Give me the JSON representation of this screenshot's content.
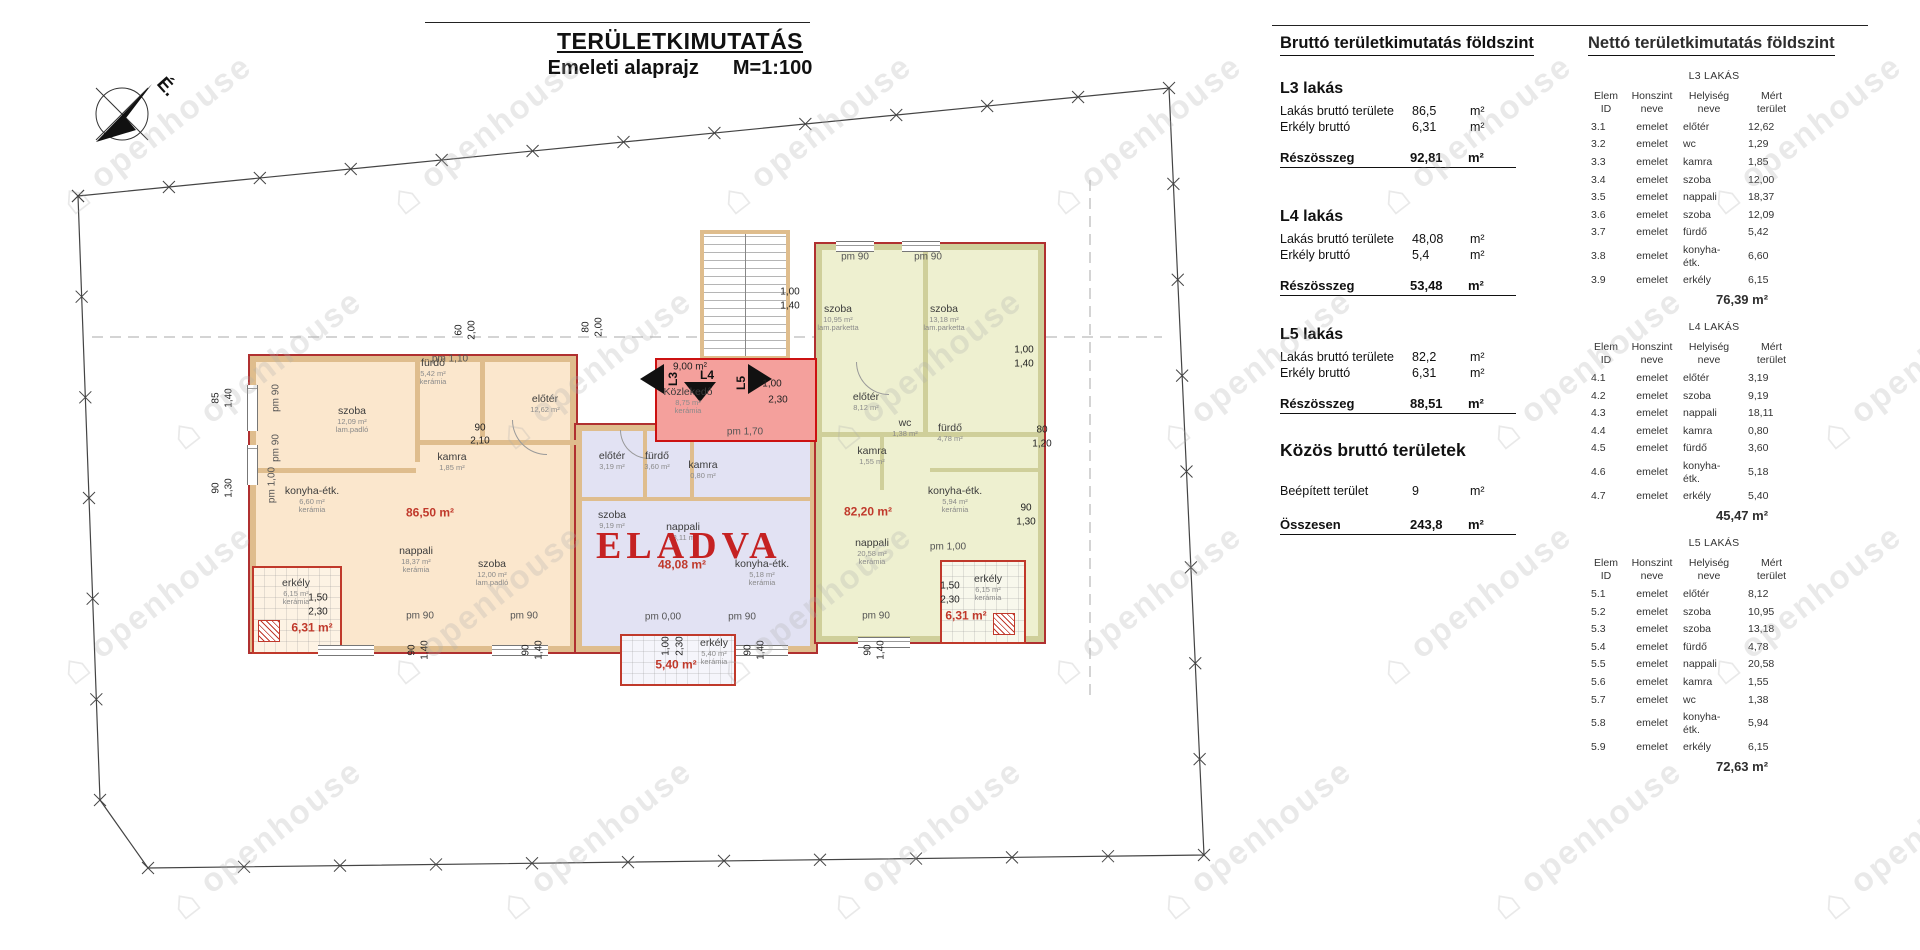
{
  "title": {
    "main": "TERÜLETKIMUTATÁS",
    "sub": "Emeleti alaprajz",
    "scale": "M=1:100"
  },
  "watermark": "openhouse",
  "plan": {
    "north_label": "É.",
    "units": [
      {
        "id": "L3",
        "fill": "#fbe7cd",
        "area": "86,50 m²"
      },
      {
        "id": "L4",
        "fill": "#e2e2f3",
        "area": "48,08 m²",
        "status": "ELADVA"
      },
      {
        "id": "L5",
        "fill": "#eef0d0",
        "area": "82,20 m²"
      }
    ],
    "corridor": {
      "doors": [
        "L3",
        "L4",
        "L5"
      ]
    },
    "labels": [
      {
        "k": "room",
        "t": "fürdő",
        "s": "5,42 m²",
        "s2": "kerámia",
        "x": 433,
        "y": 372
      },
      {
        "k": "room",
        "t": "szoba",
        "s": "12,09 m²",
        "s2": "lam.padló",
        "x": 352,
        "y": 420
      },
      {
        "k": "room",
        "t": "kamra",
        "s": "1,85 m²",
        "x": 452,
        "y": 462
      },
      {
        "k": "room",
        "t": "konyha-étk.",
        "s": "6,60 m²",
        "s2": "kerámia",
        "x": 312,
        "y": 500
      },
      {
        "k": "room",
        "t": "nappali",
        "s": "18,37 m²",
        "s2": "kerámia",
        "x": 416,
        "y": 560
      },
      {
        "k": "room",
        "t": "szoba",
        "s": "12,00 m²",
        "s2": "lam.padló",
        "x": 492,
        "y": 573
      },
      {
        "k": "room",
        "t": "előtér",
        "s": "12,62 m²",
        "x": 545,
        "y": 404
      },
      {
        "k": "red",
        "t": "86,50 m²",
        "x": 430,
        "y": 513
      },
      {
        "k": "room",
        "t": "előtér",
        "s": "3,19 m²",
        "x": 612,
        "y": 461
      },
      {
        "k": "room",
        "t": "fürdő",
        "s": "3,60 m²",
        "x": 657,
        "y": 461
      },
      {
        "k": "room",
        "t": "kamra",
        "s": "0,80 m²",
        "x": 703,
        "y": 470
      },
      {
        "k": "room",
        "t": "szoba",
        "s": "9,19 m²",
        "x": 612,
        "y": 520
      },
      {
        "k": "room",
        "t": "nappali",
        "s": "18,11 m²",
        "x": 683,
        "y": 532
      },
      {
        "k": "room",
        "t": "konyha-étk.",
        "s": "5,18 m²",
        "s2": "kerámia",
        "x": 762,
        "y": 573
      },
      {
        "k": "red",
        "t": "48,08 m²",
        "x": 682,
        "y": 565
      },
      {
        "k": "room",
        "t": "szoba",
        "s": "10,95 m²",
        "s2": "lam.parketta",
        "x": 838,
        "y": 318
      },
      {
        "k": "room",
        "t": "szoba",
        "s": "13,18 m²",
        "s2": "lam.parketta",
        "x": 944,
        "y": 318
      },
      {
        "k": "room",
        "t": "előtér",
        "s": "8,12 m²",
        "x": 866,
        "y": 402
      },
      {
        "k": "room",
        "t": "wc",
        "s": "1,38 m²",
        "x": 905,
        "y": 428
      },
      {
        "k": "room",
        "t": "fürdő",
        "s": "4,78 m²",
        "x": 950,
        "y": 433
      },
      {
        "k": "room",
        "t": "kamra",
        "s": "1,55 m²",
        "x": 872,
        "y": 456
      },
      {
        "k": "room",
        "t": "nappali",
        "s": "20,58 m²",
        "s2": "kerámia",
        "x": 872,
        "y": 552
      },
      {
        "k": "room",
        "t": "konyha-étk.",
        "s": "5,94 m²",
        "s2": "kerámia",
        "x": 955,
        "y": 500
      },
      {
        "k": "red",
        "t": "82,20 m²",
        "x": 868,
        "y": 512
      },
      {
        "k": "dim",
        "t": "9,00 m²",
        "x": 690,
        "y": 367
      },
      {
        "k": "room",
        "t": "Közlekedő",
        "s": "8,75 m²",
        "s2": "kerámia",
        "x": 688,
        "y": 401
      },
      {
        "k": "room",
        "t": "erkély",
        "s": "6,15 m²",
        "s2": "kerámia",
        "x": 296,
        "y": 592
      },
      {
        "k": "red",
        "t": "6,31 m²",
        "x": 312,
        "y": 628
      },
      {
        "k": "room",
        "t": "erkély",
        "s": "5,40 m²",
        "s2": "kerámia",
        "x": 714,
        "y": 652
      },
      {
        "k": "red",
        "t": "5,40 m²",
        "x": 676,
        "y": 665
      },
      {
        "k": "room",
        "t": "erkély",
        "s": "6,15 m²",
        "s2": "kerámia",
        "x": 988,
        "y": 588
      },
      {
        "k": "red",
        "t": "6,31 m²",
        "x": 966,
        "y": 616
      },
      {
        "k": "pm",
        "t": "pm 1,10",
        "x": 450,
        "y": 359
      },
      {
        "k": "pm",
        "t": "pm 90",
        "x": 276,
        "y": 398,
        "r": -90
      },
      {
        "k": "pm",
        "t": "pm 90",
        "x": 276,
        "y": 448,
        "r": -90
      },
      {
        "k": "pm",
        "t": "pm 1,00",
        "x": 272,
        "y": 485,
        "r": -90
      },
      {
        "k": "pm",
        "t": "pm 90",
        "x": 420,
        "y": 616
      },
      {
        "k": "pm",
        "t": "pm 90",
        "x": 524,
        "y": 616
      },
      {
        "k": "pm",
        "t": "pm 0,00",
        "x": 663,
        "y": 617
      },
      {
        "k": "pm",
        "t": "pm 90",
        "x": 742,
        "y": 617
      },
      {
        "k": "pm",
        "t": "pm 90",
        "x": 876,
        "y": 616
      },
      {
        "k": "pm",
        "t": "pm 1,00",
        "x": 948,
        "y": 547
      },
      {
        "k": "pm",
        "t": "pm 90",
        "x": 855,
        "y": 257
      },
      {
        "k": "pm",
        "t": "pm 90",
        "x": 928,
        "y": 257
      },
      {
        "k": "pm",
        "t": "pm 1,70",
        "x": 745,
        "y": 432
      },
      {
        "k": "dim",
        "t": "60",
        "x": 459,
        "y": 330,
        "r": -90
      },
      {
        "k": "dim",
        "t": "2,00",
        "x": 472,
        "y": 330,
        "r": -90
      },
      {
        "k": "dim",
        "t": "80",
        "x": 586,
        "y": 327,
        "r": -90
      },
      {
        "k": "dim",
        "t": "2,00",
        "x": 599,
        "y": 327,
        "r": -90
      },
      {
        "k": "dim",
        "t": "85",
        "x": 216,
        "y": 398,
        "r": -90
      },
      {
        "k": "dim",
        "t": "1,40",
        "x": 229,
        "y": 398,
        "r": -90
      },
      {
        "k": "dim",
        "t": "90",
        "x": 216,
        "y": 488,
        "r": -90
      },
      {
        "k": "dim",
        "t": "1,30",
        "x": 229,
        "y": 488,
        "r": -90
      },
      {
        "k": "dim",
        "t": "1,00",
        "x": 1024,
        "y": 350
      },
      {
        "k": "dim",
        "t": "1,40",
        "x": 1024,
        "y": 364
      },
      {
        "k": "dim",
        "t": "80",
        "x": 1042,
        "y": 430
      },
      {
        "k": "dim",
        "t": "1,20",
        "x": 1042,
        "y": 444
      },
      {
        "k": "dim",
        "t": "90",
        "x": 1026,
        "y": 508
      },
      {
        "k": "dim",
        "t": "1,30",
        "x": 1026,
        "y": 522
      },
      {
        "k": "dim",
        "t": "90",
        "x": 412,
        "y": 650,
        "r": -90
      },
      {
        "k": "dim",
        "t": "1,40",
        "x": 425,
        "y": 650,
        "r": -90
      },
      {
        "k": "dim",
        "t": "90",
        "x": 526,
        "y": 650,
        "r": -90
      },
      {
        "k": "dim",
        "t": "1,40",
        "x": 539,
        "y": 650,
        "r": -90
      },
      {
        "k": "dim",
        "t": "90",
        "x": 748,
        "y": 650,
        "r": -90
      },
      {
        "k": "dim",
        "t": "1,40",
        "x": 761,
        "y": 650,
        "r": -90
      },
      {
        "k": "dim",
        "t": "90",
        "x": 868,
        "y": 650,
        "r": -90
      },
      {
        "k": "dim",
        "t": "1,40",
        "x": 881,
        "y": 650,
        "r": -90
      },
      {
        "k": "dim",
        "t": "1,00",
        "x": 790,
        "y": 292
      },
      {
        "k": "dim",
        "t": "1,40",
        "x": 790,
        "y": 306
      },
      {
        "k": "dim",
        "t": "1,00",
        "x": 772,
        "y": 384
      },
      {
        "k": "dim",
        "t": "2,30",
        "x": 778,
        "y": 400
      },
      {
        "k": "dim",
        "t": "1,50",
        "x": 318,
        "y": 598
      },
      {
        "k": "dim",
        "t": "2,30",
        "x": 318,
        "y": 612
      },
      {
        "k": "dim",
        "t": "1,50",
        "x": 950,
        "y": 586
      },
      {
        "k": "dim",
        "t": "2,30",
        "x": 950,
        "y": 600
      },
      {
        "k": "dim",
        "t": "1,00",
        "x": 666,
        "y": 646,
        "r": -90
      },
      {
        "k": "dim",
        "t": "2,30",
        "x": 680,
        "y": 646,
        "r": -90
      },
      {
        "k": "dim",
        "t": "90",
        "x": 480,
        "y": 428
      },
      {
        "k": "dim",
        "t": "2,10",
        "x": 480,
        "y": 441
      }
    ]
  },
  "brutto": {
    "heading": "Bruttó területkimutatás földszint",
    "sections": [
      {
        "name": "L3 lakás",
        "rows": [
          [
            "Lakás bruttó területe",
            "86,5",
            "m²"
          ],
          [
            "Erkély bruttó",
            "6,31",
            "m²"
          ]
        ],
        "subtotal": {
          "label": "Részösszeg",
          "value": "92,81",
          "unit": "m²"
        }
      },
      {
        "name": "L4 lakás",
        "rows": [
          [
            "Lakás bruttó területe",
            "48,08",
            "m²"
          ],
          [
            "Erkély bruttó",
            "5,4",
            "m²"
          ]
        ],
        "subtotal": {
          "label": "Részösszeg",
          "value": "53,48",
          "unit": "m²"
        }
      },
      {
        "name": "L5 lakás",
        "rows": [
          [
            "Lakás bruttó területe",
            "82,2",
            "m²"
          ],
          [
            "Erkély bruttó",
            "6,31",
            "m²"
          ]
        ],
        "subtotal": {
          "label": "Részösszeg",
          "value": "88,51",
          "unit": "m²"
        }
      }
    ],
    "common": {
      "heading": "Közös bruttó területek",
      "row": [
        "Beépített terület",
        "9",
        "m²"
      ],
      "total": {
        "label": "Összesen",
        "value": "243,8",
        "unit": "m²"
      }
    }
  },
  "netto": {
    "heading": "Nettó területkimutatás földszint",
    "col_headers": [
      "Elem\nID",
      "Honszint\nneve",
      "Helyiség\nneve",
      "Mért\nterület"
    ],
    "tables": [
      {
        "title": "L3 LAKÁS",
        "rows": [
          [
            "3.1",
            "emelet",
            "előtér",
            "12,62"
          ],
          [
            "3.2",
            "emelet",
            "wc",
            "1,29"
          ],
          [
            "3.3",
            "emelet",
            "kamra",
            "1,85"
          ],
          [
            "3.4",
            "emelet",
            "szoba",
            "12,00"
          ],
          [
            "3.5",
            "emelet",
            "nappali",
            "18,37"
          ],
          [
            "3.6",
            "emelet",
            "szoba",
            "12,09"
          ],
          [
            "3.7",
            "emelet",
            "fürdő",
            "5,42"
          ],
          [
            "3.8",
            "emelet",
            "konyha-étk.",
            "6,60"
          ],
          [
            "3.9",
            "emelet",
            "erkély",
            "6,15"
          ]
        ],
        "total": "76,39 m²"
      },
      {
        "title": "L4 LAKÁS",
        "rows": [
          [
            "4.1",
            "emelet",
            "előtér",
            "3,19"
          ],
          [
            "4.2",
            "emelet",
            "szoba",
            "9,19"
          ],
          [
            "4.3",
            "emelet",
            "nappali",
            "18,11"
          ],
          [
            "4.4",
            "emelet",
            "kamra",
            "0,80"
          ],
          [
            "4.5",
            "emelet",
            "fürdő",
            "3,60"
          ],
          [
            "4.6",
            "emelet",
            "konyha-étk.",
            "5,18"
          ],
          [
            "4.7",
            "emelet",
            "erkély",
            "5,40"
          ]
        ],
        "total": "45,47 m²"
      },
      {
        "title": "L5 LAKÁS",
        "rows": [
          [
            "5.1",
            "emelet",
            "előtér",
            "8,12"
          ],
          [
            "5.2",
            "emelet",
            "szoba",
            "10,95"
          ],
          [
            "5.3",
            "emelet",
            "szoba",
            "13,18"
          ],
          [
            "5.4",
            "emelet",
            "fürdő",
            "4,78"
          ],
          [
            "5.5",
            "emelet",
            "nappali",
            "20,58"
          ],
          [
            "5.6",
            "emelet",
            "kamra",
            "1,55"
          ],
          [
            "5.7",
            "emelet",
            "wc",
            "1,38"
          ],
          [
            "5.8",
            "emelet",
            "konyha-étk.",
            "5,94"
          ],
          [
            "5.9",
            "emelet",
            "erkély",
            "6,15"
          ]
        ],
        "total": "72,63 m²"
      }
    ]
  }
}
